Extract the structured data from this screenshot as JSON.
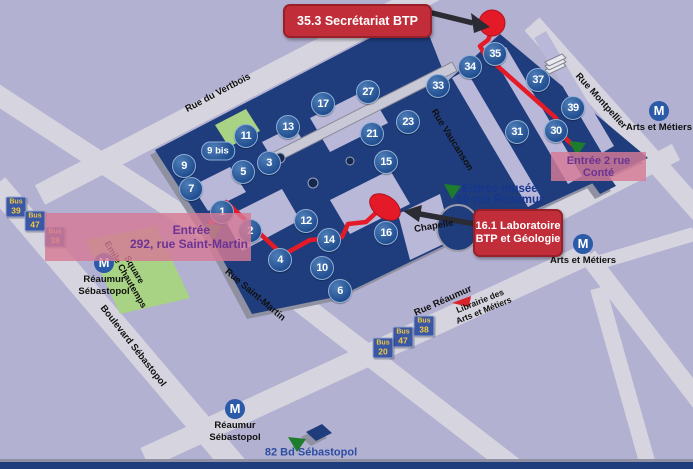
{
  "colors": {
    "background": "#b3b1d1",
    "street": "#d6d5df",
    "building": "#1f3d7d",
    "building_side": "#8f91a2",
    "courtyard": "#bab8d9",
    "park_green": "#a8d284",
    "route_red": "#e41a28",
    "callout_red": "#c12e3a",
    "entrance_green": "#1e7d2c",
    "pink_box": "#d67a96",
    "purple_text": "#6c3394",
    "metro_blue": "#2a5aa8",
    "bus_badge_blue": "#3a57a5",
    "bus_text_yellow": "#f2c83e",
    "museum_text_blue": "#16368f"
  },
  "callouts": {
    "secretariat": {
      "text": "35.3 Secrétariat BTP"
    },
    "laboratoire": {
      "line1": "16.1 Laboratoire",
      "line2": "BTP et Géologie"
    }
  },
  "entrances": {
    "conte": {
      "text": "Entrée  2 rue Conté"
    },
    "saint_martin": {
      "line1": "Entrée",
      "line2": "292, rue Saint-Martin"
    },
    "musee": {
      "line1": "Entrée musée",
      "line2": "60 rue Réaumur"
    },
    "sebastopol_82": {
      "text": "82 Bd Sébastopol"
    }
  },
  "access_markers": [
    {
      "n": "1",
      "x": 222,
      "y": 212
    },
    {
      "n": "2",
      "x": 250,
      "y": 231
    },
    {
      "n": "3",
      "x": 269,
      "y": 163
    },
    {
      "n": "4",
      "x": 280,
      "y": 260
    },
    {
      "n": "5",
      "x": 243,
      "y": 172
    },
    {
      "n": "6",
      "x": 340,
      "y": 291
    },
    {
      "n": "7",
      "x": 191,
      "y": 189
    },
    {
      "n": "9",
      "x": 184,
      "y": 166
    },
    {
      "n": "10",
      "x": 322,
      "y": 268
    },
    {
      "n": "11",
      "x": 246,
      "y": 136
    },
    {
      "n": "12",
      "x": 306,
      "y": 221
    },
    {
      "n": "13",
      "x": 288,
      "y": 127
    },
    {
      "n": "14",
      "x": 329,
      "y": 240
    },
    {
      "n": "15",
      "x": 386,
      "y": 162
    },
    {
      "n": "16",
      "x": 386,
      "y": 233
    },
    {
      "n": "17",
      "x": 323,
      "y": 104
    },
    {
      "n": "21",
      "x": 372,
      "y": 134
    },
    {
      "n": "23",
      "x": 408,
      "y": 122
    },
    {
      "n": "27",
      "x": 368,
      "y": 92
    },
    {
      "n": "30",
      "x": 556,
      "y": 131
    },
    {
      "n": "31",
      "x": 517,
      "y": 132
    },
    {
      "n": "33",
      "x": 438,
      "y": 86
    },
    {
      "n": "34",
      "x": 470,
      "y": 67
    },
    {
      "n": "35",
      "x": 495,
      "y": 54
    },
    {
      "n": "37",
      "x": 538,
      "y": 80
    },
    {
      "n": "39",
      "x": 573,
      "y": 108
    }
  ],
  "access_marker_bis": {
    "text": "9 bis",
    "x": 218,
    "y": 151
  },
  "metro_stations": [
    {
      "id": "arts-et-metiers-nord",
      "x": 659,
      "y": 117,
      "lines": [
        "Arts et Métiers"
      ]
    },
    {
      "id": "arts-et-metiers-sud",
      "x": 583,
      "y": 250,
      "lines": [
        "Arts et Métiers"
      ]
    },
    {
      "id": "reaumur-sebastopol-ouest",
      "x": 104,
      "y": 275,
      "lines": [
        "Réaumur",
        "Sébastopol"
      ]
    },
    {
      "id": "reaumur-sebastopol-sud",
      "x": 235,
      "y": 421,
      "lines": [
        "Réaumur",
        "Sébastopol"
      ]
    }
  ],
  "bus_stops": [
    {
      "prefix": "Bus",
      "num": "39",
      "x": 16,
      "y": 207
    },
    {
      "prefix": "Bus",
      "num": "47",
      "x": 35,
      "y": 221
    },
    {
      "prefix": "Bus",
      "num": "38",
      "x": 55,
      "y": 237
    },
    {
      "prefix": "Bus",
      "num": "38",
      "x": 424,
      "y": 326
    },
    {
      "prefix": "Bus",
      "num": "47",
      "x": 403,
      "y": 337
    },
    {
      "prefix": "Bus",
      "num": "20",
      "x": 383,
      "y": 348
    }
  ],
  "street_labels": [
    {
      "text": "Rue du Vertbois",
      "x": 218,
      "y": 93,
      "rot": -28
    },
    {
      "text": "Rue Vaucanson",
      "x": 452,
      "y": 140,
      "rot": 58
    },
    {
      "text": "Rue Montpellier",
      "x": 601,
      "y": 101,
      "rot": 48
    },
    {
      "text": "Rue Réaumur",
      "x": 443,
      "y": 301,
      "rot": -24
    },
    {
      "text": "Rue Saint-Martin",
      "x": 255,
      "y": 295,
      "rot": 40
    },
    {
      "text": "Boulevard Sébastopol",
      "x": 133,
      "y": 346,
      "rot": 52
    }
  ],
  "area_labels": [
    {
      "id": "square-emile-chautemps",
      "lines": [
        "Square",
        "Emile Chautemps"
      ],
      "x": 130,
      "y": 272,
      "rot": 60,
      "size": 9
    },
    {
      "id": "chapelle",
      "lines": [
        "Chapelle"
      ],
      "x": 434,
      "y": 227,
      "rot": -10,
      "size": 9.5
    },
    {
      "id": "librairie-arts-et-metiers",
      "lines": [
        "Librairie des",
        "Arts et Métiers"
      ],
      "x": 482,
      "y": 306,
      "rot": -22,
      "size": 8.5
    }
  ]
}
